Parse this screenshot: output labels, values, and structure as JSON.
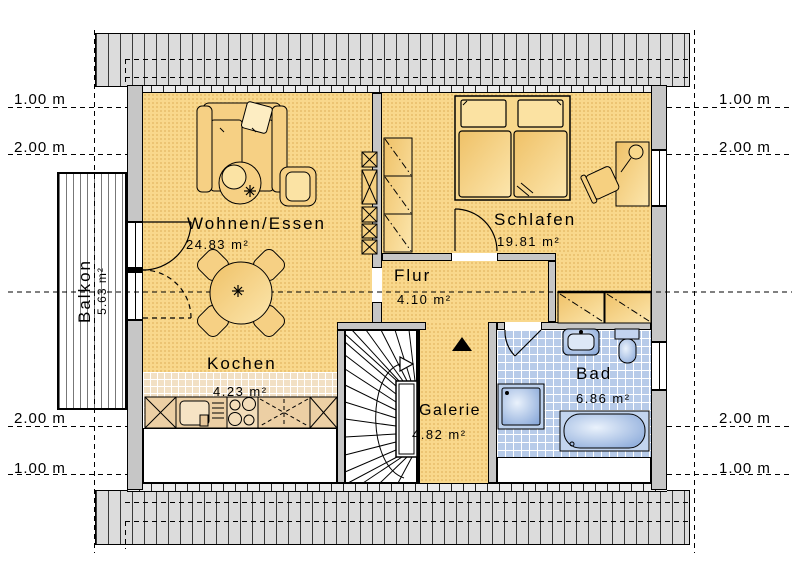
{
  "rooms": {
    "wohnen": {
      "label": "Wohnen/Essen",
      "area": "24.83 m²"
    },
    "schlafen": {
      "label": "Schlafen",
      "area": "19.81 m²"
    },
    "flur": {
      "label": "Flur",
      "area": "4.10 m²"
    },
    "kochen": {
      "label": "Kochen",
      "area": "4.23 m²"
    },
    "galerie": {
      "label": "Galerie",
      "area": "4.82 m²"
    },
    "bad": {
      "label": "Bad",
      "area": "6.86 m²"
    },
    "balkon": {
      "label": "Balkon",
      "area": "5.63 m²"
    }
  },
  "dimension_labels": {
    "left": [
      "1.00 m",
      "2.00 m",
      "2.00 m",
      "1.00 m"
    ],
    "right": [
      "1.00 m",
      "2.00 m",
      "2.00 m",
      "1.00 m"
    ]
  },
  "colors": {
    "room_fill": "#f9d88c",
    "kitchen_tile": "#f2e0c4",
    "bath_tile": "#b7cbe9",
    "wall_gray": "#c6c6c6",
    "roof_band_gray": "#dcdcdc",
    "fixture_blue": "#9db8e0",
    "line_black": "#000000"
  }
}
